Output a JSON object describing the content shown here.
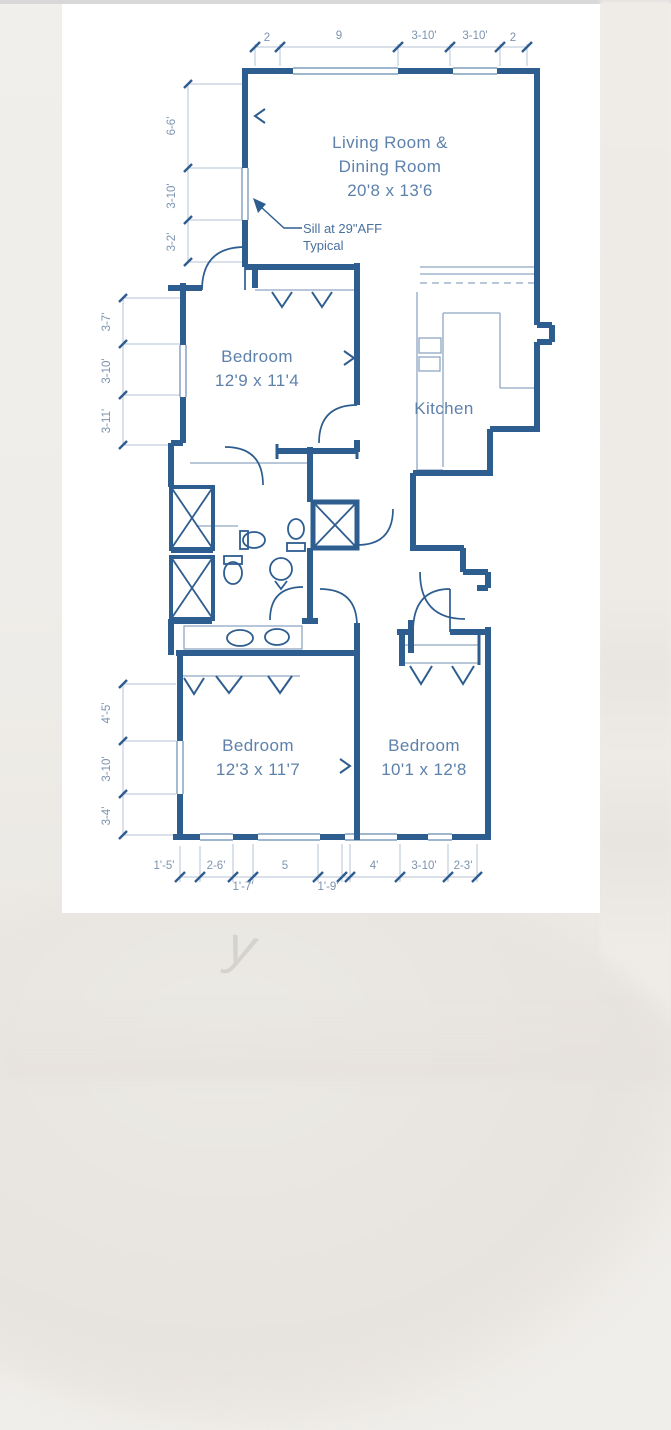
{
  "background": {
    "watermark_glyph": "y"
  },
  "plan": {
    "rooms": {
      "living_dining": {
        "line1": "Living Room &",
        "line2": "Dining Room",
        "dims": "20'8 x 13'6"
      },
      "bedroom1": {
        "name": "Bedroom",
        "dims": "12'9 x 11'4"
      },
      "kitchen": {
        "name": "Kitchen"
      },
      "bedroom2": {
        "name": "Bedroom",
        "dims": "12'3 x 11'7"
      },
      "bedroom3": {
        "name": "Bedroom",
        "dims": "10'1 x 12'8"
      }
    },
    "notes": {
      "sill": {
        "line1": "Sill at 29\"AFF",
        "line2": "Typical"
      }
    },
    "dims": {
      "top": [
        "2",
        "9",
        "3-10'",
        "3-10'",
        "2"
      ],
      "left_upper": [
        "6-6'",
        "3-10'",
        "3-2'"
      ],
      "left_middle": [
        "3-7'",
        "3-10'",
        "3-11'"
      ],
      "left_lower": [
        "4'-5'",
        "3-10'",
        "3-4'"
      ],
      "bottom_row1": [
        "1'-5'",
        "2-6'",
        "5",
        "4'",
        "3-10'",
        "2-3'"
      ],
      "bottom_row2": [
        "1'-7'",
        "1'-9'"
      ]
    },
    "colors": {
      "wall": "#2e5d8f",
      "room_text": "#5d81ab",
      "dim_text": "#7d93af",
      "paper": "#ffffff"
    }
  }
}
